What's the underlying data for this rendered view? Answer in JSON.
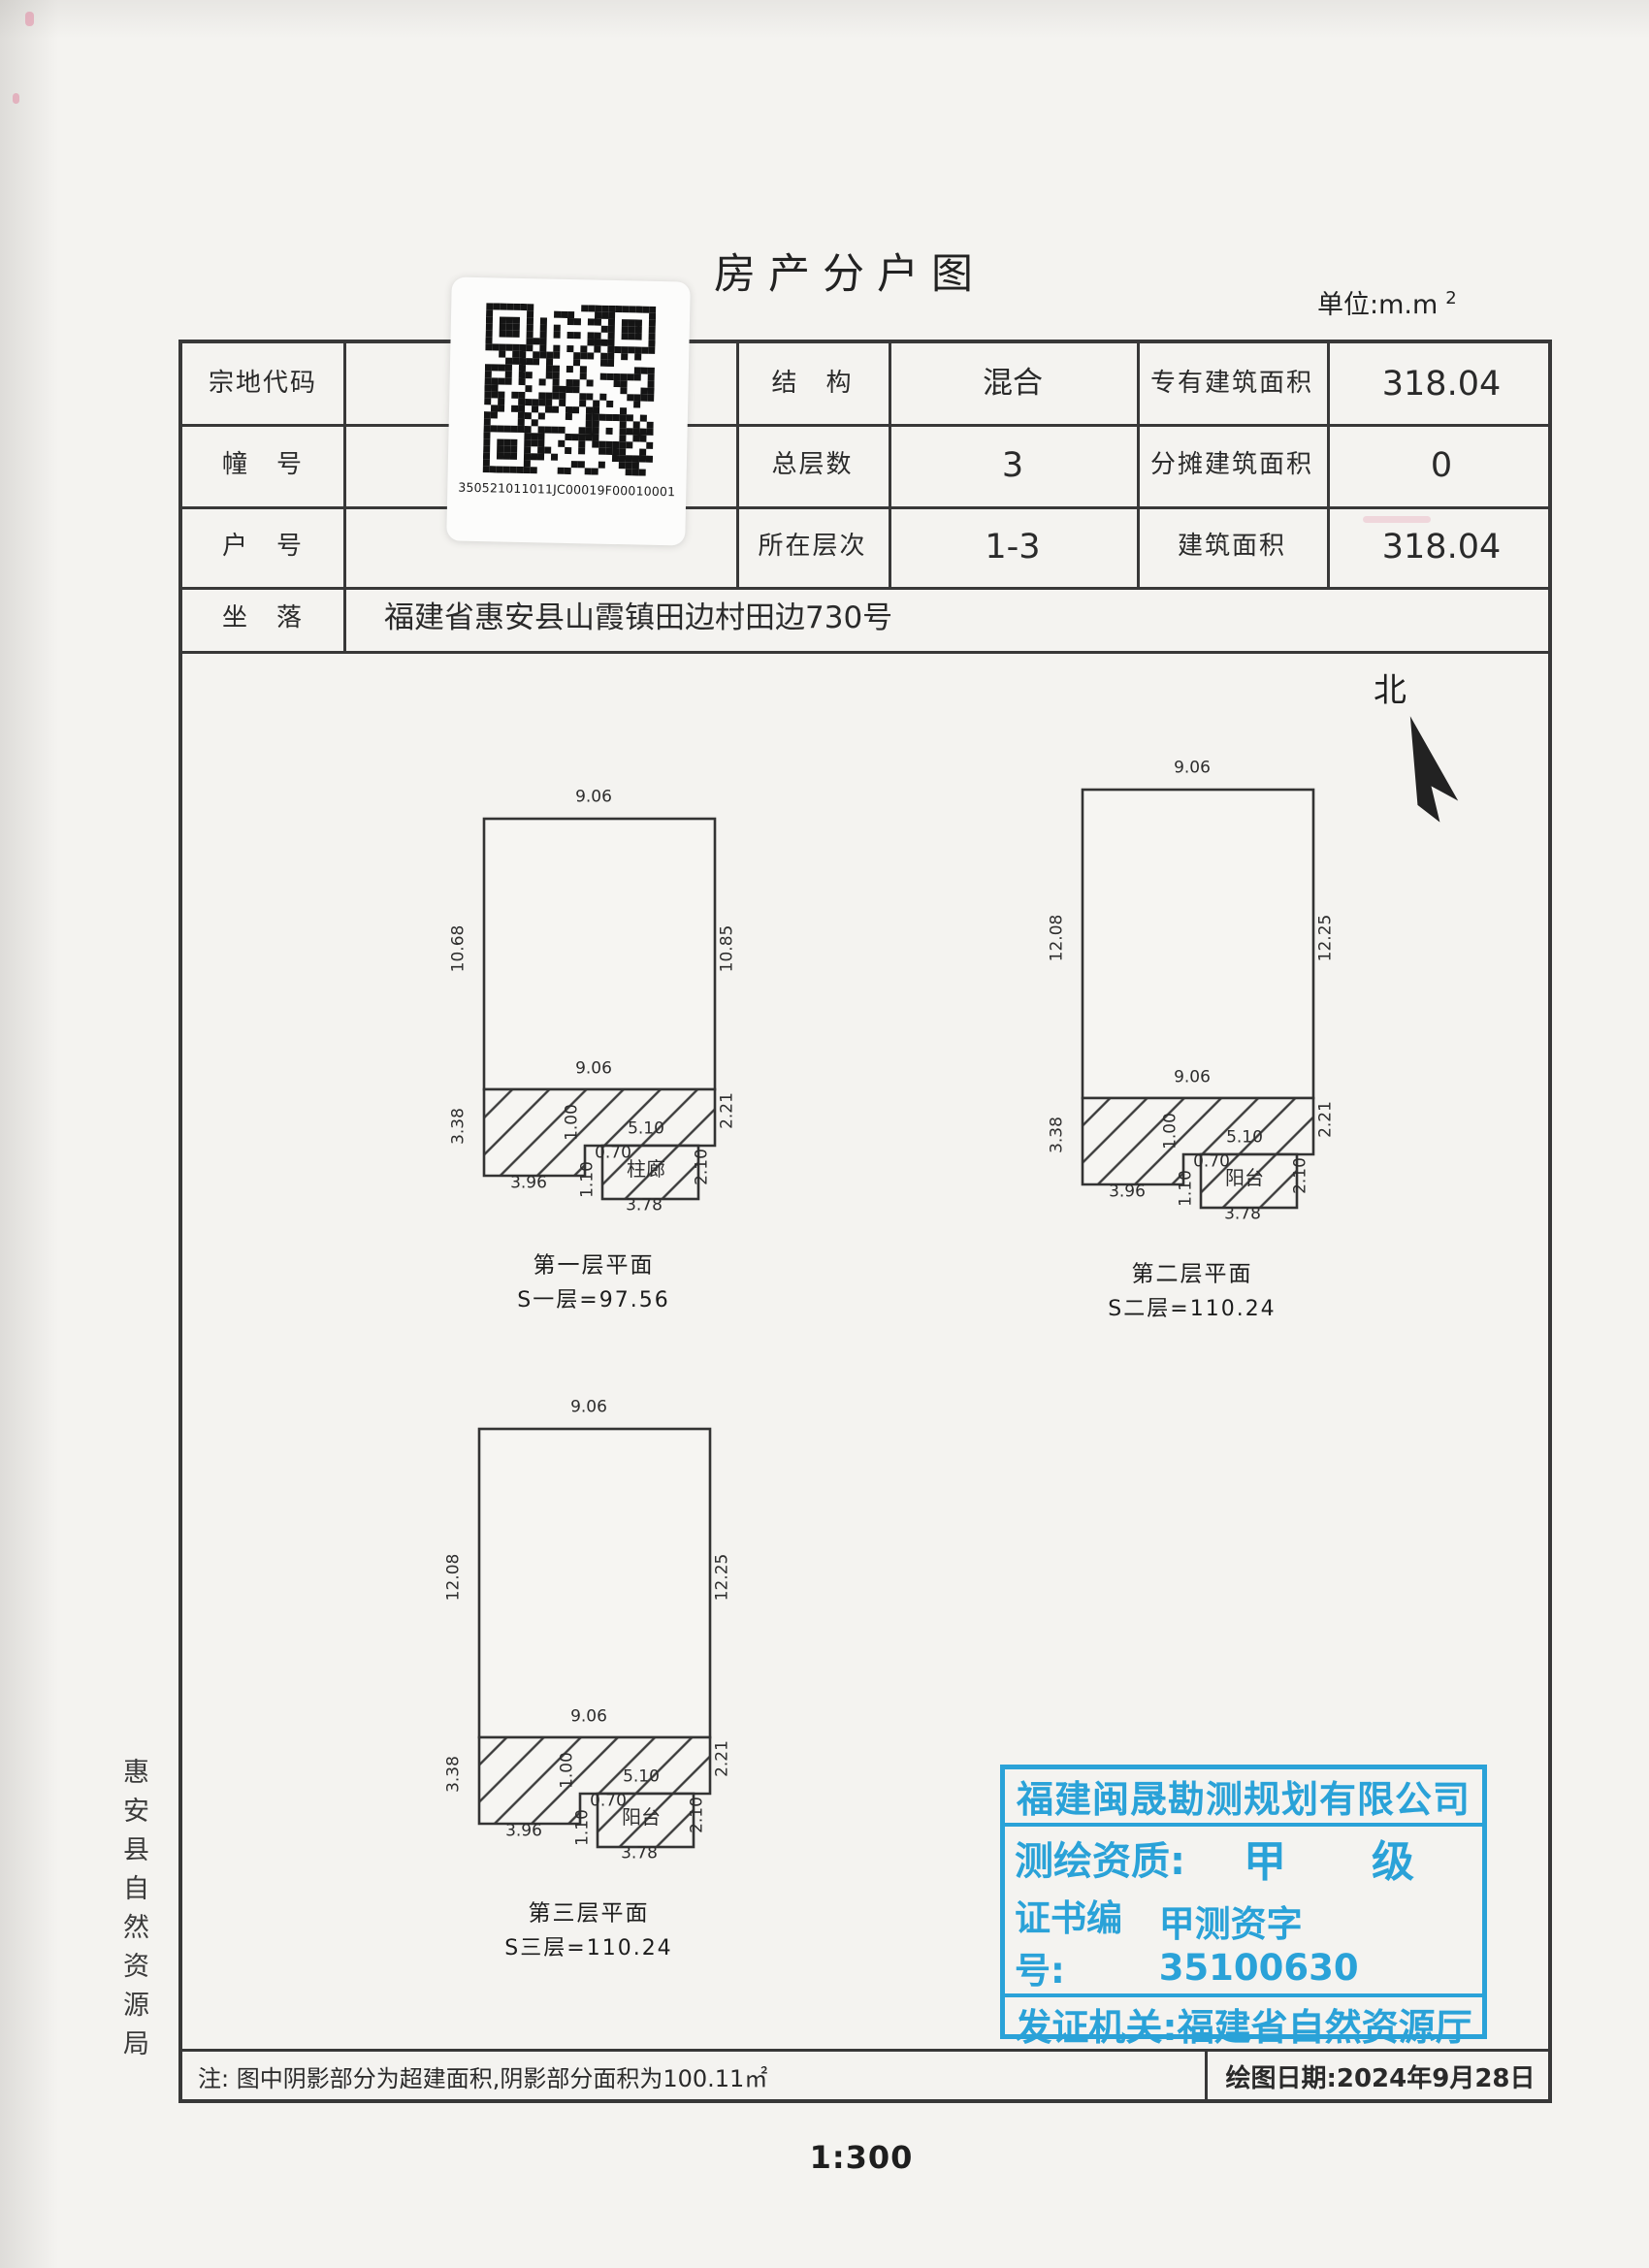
{
  "page": {
    "title": "房产分户图",
    "unit_prefix": "单位:m.m",
    "unit_exponent": "2",
    "scale_text": "1:300",
    "north_label": "北",
    "side_agency_text": "惠安县自然资源局"
  },
  "qr_sticker": {
    "code_text": "350521011011JC00019F00010001"
  },
  "info_table": {
    "parcel_code_label": "宗地代码",
    "building_no_label": "幢　号",
    "unit_no_label": "户　号",
    "location_label": "坐　落",
    "location_value": "福建省惠安县山霞镇田边村田边730号",
    "structure_label": "结　构",
    "structure_value": "混合",
    "total_floors_label": "总层数",
    "total_floors_value": "3",
    "floor_range_label": "所在层次",
    "floor_range_value": "1-3",
    "exclusive_area_label": "专有建筑面积",
    "exclusive_area_value": "318.04",
    "shared_area_label": "分摊建筑面积",
    "shared_area_value": "0",
    "building_area_label": "建筑面积",
    "building_area_value": "318.04"
  },
  "plans": [
    {
      "caption": "第一层平面",
      "area_formula": "S一层=97.56",
      "room_label": "柱廊",
      "dims": {
        "top": "9.06",
        "left": "10.68",
        "right": "10.85",
        "bottom_inner": "9.06",
        "hatch_left": "3.38",
        "hatch_right": "2.21",
        "bottom_left": "3.96",
        "step": "1.00",
        "mid": "5.10",
        "offset": "0.70",
        "porch_left": "1.10",
        "porch_right": "2.10",
        "porch_bottom": "3.78"
      }
    },
    {
      "caption": "第二层平面",
      "area_formula": "S二层=110.24",
      "room_label": "阳台",
      "dims": {
        "top": "9.06",
        "left": "12.08",
        "right": "12.25",
        "bottom_inner": "9.06",
        "hatch_left": "3.38",
        "hatch_right": "2.21",
        "bottom_left": "3.96",
        "step": "1.00",
        "mid": "5.10",
        "offset": "0.70",
        "porch_left": "1.10",
        "porch_right": "2.10",
        "porch_bottom": "3.78"
      }
    },
    {
      "caption": "第三层平面",
      "area_formula": "S三层=110.24",
      "room_label": "阳台",
      "dims": {
        "top": "9.06",
        "left": "12.08",
        "right": "12.25",
        "bottom_inner": "9.06",
        "hatch_left": "3.38",
        "hatch_right": "2.21",
        "bottom_left": "3.96",
        "step": "1.00",
        "mid": "5.10",
        "offset": "0.70",
        "porch_left": "1.10",
        "porch_right": "2.10",
        "porch_bottom": "3.78"
      }
    }
  ],
  "stamp": {
    "company": "福建闽晟勘测规划有限公司",
    "qualification_label": "测绘资质:",
    "qualification_value": "甲　　级",
    "cert_label": "证书编号:",
    "cert_value": "甲测资字35100630",
    "issuer_label": "发证机关:",
    "issuer_value": "福建省自然资源厅",
    "color": "#2aa2d8"
  },
  "footer": {
    "note": "注: 图中阴影部分为超建面积,阴影部分面积为100.11㎡",
    "date_text": "绘图日期:2024年9月28日"
  }
}
